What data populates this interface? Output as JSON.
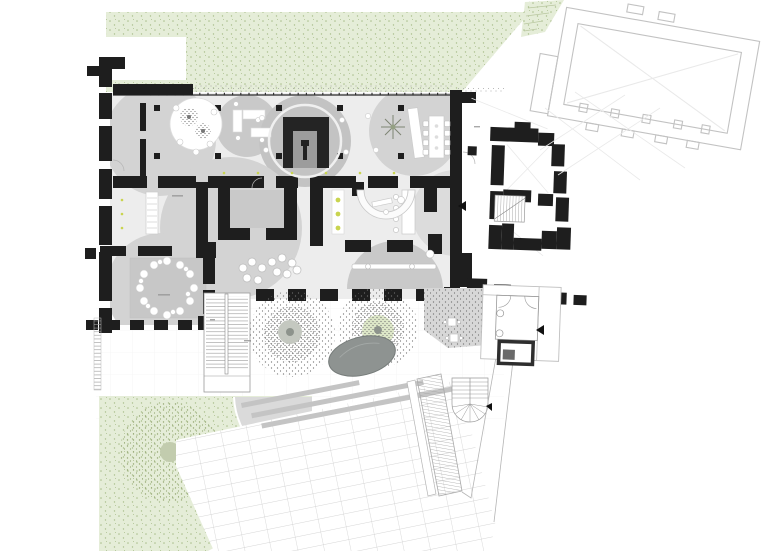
{
  "document": {
    "kind": "architectural ground-floor site plan",
    "note": "tiny room-label annotations are present but illegible at source resolution"
  },
  "colors": {
    "wall": "#1e1e1e",
    "floor": "#ededed",
    "circle": "#d3d3d3",
    "circleMid": "#c9c9c9",
    "circleDark": "#c3c3c3",
    "rugGray": "#c7c7c7",
    "lawnBase": "#e5edd8",
    "lawnDot": "#abbf8d",
    "treeDot": "#6f6f6f",
    "lawnTreeDot": "#93a571",
    "innerGreen": "#dde7c8",
    "stage": "#242424",
    "stageInner": "#9c9c9c",
    "accent": "#c9d44f",
    "boulder": "#8e9391",
    "boulderEdge": "#757b79",
    "outline": "#c2c2c2",
    "lineFaint": "#e9e9e9",
    "grid": "#c9c9c9",
    "hatch": "#9b9b9b",
    "paleLine": "#b5b5b5",
    "gravelDot": "#9a9a9a",
    "white": "#ffffff"
  },
  "areas": [
    "north lawn",
    "terrace cut-out",
    "long hall with column grid",
    "round-table room",
    "stage room",
    "workshop room",
    "conference room",
    "light corridor",
    "reception counter",
    "bench lounge",
    "flower-chair lounge",
    "south lawn",
    "plaza with rotated paving",
    "grand exterior stair",
    "hatched ramp stair",
    "spiral stair",
    "boulder",
    "plaza trees",
    "east wing (existing, black poché)",
    "neighbor building (outline only)",
    "south annex rooms"
  ],
  "symbols": [
    "column-symbol",
    "tree-symbol",
    "shrub-symbol",
    "boulder-symbol",
    "stage-symbol",
    "stair-symbol",
    "spiral-stair-symbol",
    "ramp-hatch-symbol",
    "flower-chair-symbol",
    "snowflake-plant-symbol",
    "door-swing-symbol",
    "direction-triangle-symbol",
    "light-fixture-dot-symbol"
  ]
}
